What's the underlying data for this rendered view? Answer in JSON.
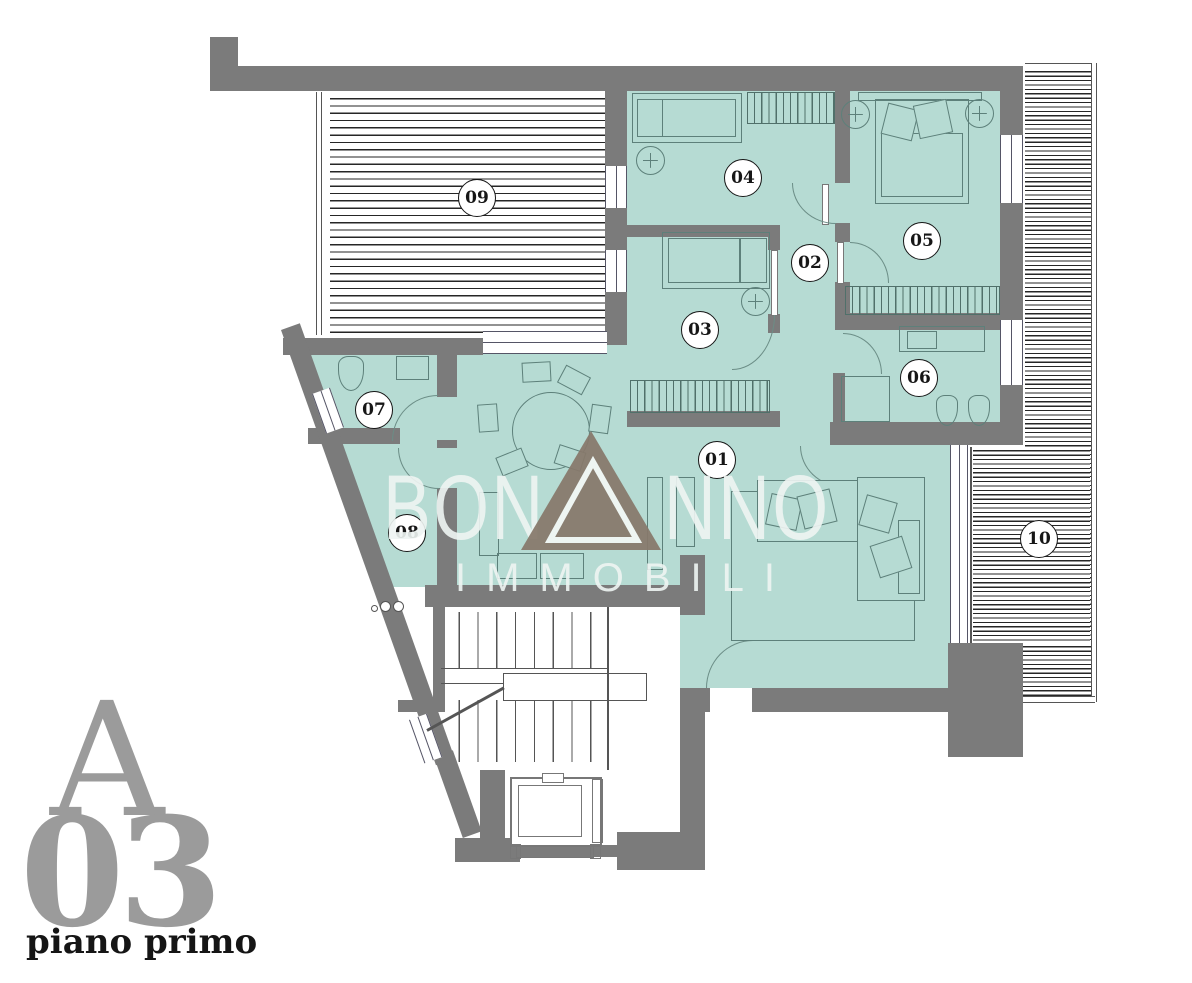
{
  "plan": {
    "rooms": [
      {
        "label": "01"
      },
      {
        "label": "02"
      },
      {
        "label": "03"
      },
      {
        "label": "04"
      },
      {
        "label": "05"
      },
      {
        "label": "06"
      },
      {
        "label": "07"
      },
      {
        "label": "08"
      },
      {
        "label": "09"
      },
      {
        "label": "10"
      }
    ],
    "watermark": {
      "name_left": "BON",
      "name_right": "NNO",
      "subtitle": "IMMOBILI"
    },
    "branding": {
      "unit_letter": "A",
      "unit_number": "03",
      "floor_label": "piano primo"
    },
    "colors": {
      "floor": "#b6dbd3",
      "wall": "#7b7b7b",
      "line": "#5d807a",
      "hatch": "#262626",
      "wm": "#eff5f3",
      "logo": "#87796b",
      "brand": "#9b9b9b"
    }
  }
}
